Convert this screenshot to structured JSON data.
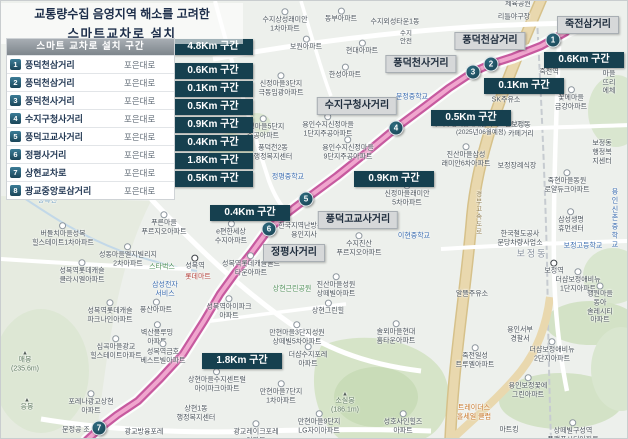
{
  "title": {
    "line1": "교통량수집 음영지역 해소를 고려한",
    "line2": "스마트교차로 설치"
  },
  "table": {
    "header": "스마트 교차로 설치 구간",
    "rows": [
      {
        "no": "1",
        "name": "풍덕천삼거리",
        "road": "포은대로"
      },
      {
        "no": "2",
        "name": "풍덕천삼거리",
        "road": "포은대로"
      },
      {
        "no": "3",
        "name": "풍덕천사거리",
        "road": "포은대로"
      },
      {
        "no": "4",
        "name": "수지구청사거리",
        "road": "포은대로"
      },
      {
        "no": "5",
        "name": "풍덕고교사거리",
        "road": "포은대로"
      },
      {
        "no": "6",
        "name": "정평사거리",
        "road": "포은대로"
      },
      {
        "no": "7",
        "name": "상현교차로",
        "road": "포은대로"
      },
      {
        "no": "8",
        "name": "광교중앙로삼거리",
        "road": "포은대로"
      }
    ]
  },
  "segments": [
    {
      "label": "4.8Km 구간",
      "x": 212,
      "y": 46
    },
    {
      "label": "0.6Km 구간",
      "x": 212,
      "y": 70
    },
    {
      "label": "0.1Km 구간",
      "x": 212,
      "y": 88
    },
    {
      "label": "0.5Km 구간",
      "x": 212,
      "y": 106
    },
    {
      "label": "0.9Km 구간",
      "x": 212,
      "y": 124
    },
    {
      "label": "0.4Km 구간",
      "x": 212,
      "y": 142
    },
    {
      "label": "1.8Km 구간",
      "x": 212,
      "y": 160
    },
    {
      "label": "0.5Km 구간",
      "x": 212,
      "y": 178
    }
  ],
  "map": {
    "colors": {
      "badge": "#16404f",
      "route_outer": "#c75a9f",
      "route_inner": "#f0a6ce",
      "plate": "#d6d8d9"
    },
    "badges": [
      {
        "label": "0.6Km 구간",
        "x": 583,
        "y": 59
      },
      {
        "label": "0.1Km 구간",
        "x": 523,
        "y": 85
      },
      {
        "label": "0.5Km 구간",
        "x": 470,
        "y": 117
      },
      {
        "label": "0.9Km 구간",
        "x": 393,
        "y": 178
      },
      {
        "label": "0.4Km 구간",
        "x": 249,
        "y": 212
      },
      {
        "label": "1.8Km 구간",
        "x": 241,
        "y": 360
      }
    ],
    "intersections": [
      {
        "label": "죽전삼거리",
        "x": 587,
        "y": 24
      },
      {
        "label": "풍덕천삼거리",
        "x": 489,
        "y": 40
      },
      {
        "label": "풍덕천사거리",
        "x": 420,
        "y": 63
      },
      {
        "label": "수지구청사거리",
        "x": 356,
        "y": 105
      },
      {
        "label": "풍덕고교사거리",
        "x": 357,
        "y": 219
      },
      {
        "label": "정평사거리",
        "x": 293,
        "y": 252
      }
    ],
    "markers": [
      {
        "n": "1",
        "x": 552,
        "y": 39
      },
      {
        "n": "2",
        "x": 490,
        "y": 63
      },
      {
        "n": "3",
        "x": 472,
        "y": 71
      },
      {
        "n": "4",
        "x": 395,
        "y": 127
      },
      {
        "n": "5",
        "x": 305,
        "y": 198
      },
      {
        "n": "6",
        "x": 268,
        "y": 228
      },
      {
        "n": "7",
        "x": 98,
        "y": 427
      }
    ],
    "labels": [
      {
        "t": "체육공원",
        "x": 517,
        "y": 4
      },
      {
        "t": "리틀야구장",
        "x": 513,
        "y": 17
      },
      {
        "t": "수지상성래미안\n1차아파트",
        "x": 284,
        "y": 20,
        "cls": "apt"
      },
      {
        "t": "동부아파트",
        "x": 340,
        "y": 15,
        "cls": "apt"
      },
      {
        "t": "수지외성타운1동",
        "x": 394,
        "y": 22
      },
      {
        "t": "보원아파트",
        "x": 305,
        "y": 43,
        "cls": "apt"
      },
      {
        "t": "현대아파트",
        "x": 361,
        "y": 47,
        "cls": "apt"
      },
      {
        "t": "한성아파트",
        "x": 344,
        "y": 71,
        "cls": "apt"
      },
      {
        "t": "수지\n안전",
        "x": 405,
        "y": 37,
        "cls": "tiny"
      },
      {
        "t": "도담마을\n뜨리에체",
        "x": 608,
        "y": 74,
        "cls": "apt"
      },
      {
        "t": "죽전역",
        "x": 548,
        "y": 68,
        "cls": "station"
      },
      {
        "t": "꽃메마을\n금강아파트",
        "x": 570,
        "y": 98,
        "cls": "apt"
      },
      {
        "t": "SK주유소",
        "x": 505,
        "y": 100
      },
      {
        "t": "신정마을3단지\n극동임광아파트",
        "x": 280,
        "y": 84,
        "cls": "apt"
      },
      {
        "t": "문정중학교",
        "x": 411,
        "y": 97,
        "cls": "blue"
      },
      {
        "t": "용인수지신정마을\n1단지주공아파트",
        "x": 327,
        "y": 125,
        "cls": "apt"
      },
      {
        "t": "신정마을5단지\n주공아파트",
        "x": 262,
        "y": 127,
        "cls": "apt"
      },
      {
        "t": "수지구청역롯데캐슬하이브엘아파트\n(2025년06월예정)",
        "x": 480,
        "y": 128,
        "cls": "tiny"
      },
      {
        "t": "풍덕천2동\n행정복지센터",
        "x": 272,
        "y": 152
      },
      {
        "t": "용인수지신정마을\n9단지주공아파트",
        "x": 347,
        "y": 148,
        "cls": "apt"
      },
      {
        "t": "정평중학교",
        "x": 287,
        "y": 177,
        "cls": "blue"
      },
      {
        "t": "신정마을래미안\n5차아파트",
        "x": 406,
        "y": 194,
        "cls": "apt"
      },
      {
        "t": "진산마을삼성\n래미안6차아파트",
        "x": 465,
        "y": 155,
        "cls": "apt"
      },
      {
        "t": "보정장례식장",
        "x": 516,
        "y": 166
      },
      {
        "t": "보정동\n카페거리",
        "x": 520,
        "y": 129
      },
      {
        "t": "보정동\n행정복지센터",
        "x": 601,
        "y": 152
      },
      {
        "t": "죽현마을동원\n로얄듀크아파트",
        "x": 566,
        "y": 181,
        "cls": "apt"
      },
      {
        "t": "경부고속도로",
        "x": 476,
        "y": 212,
        "cls": "road-v"
      },
      {
        "t": "삼성생명\n휴먼센터",
        "x": 570,
        "y": 220,
        "cls": "apt"
      },
      {
        "t": "용인신촌\n중학교",
        "x": 614,
        "y": 218,
        "cls": "blue"
      },
      {
        "t": "한국철도공사\n분당차량사업소",
        "x": 519,
        "y": 238
      },
      {
        "t": "보정동",
        "x": 531,
        "y": 253,
        "cls": "district"
      },
      {
        "t": "보정고등학교",
        "x": 582,
        "y": 246,
        "cls": "blue"
      },
      {
        "t": "보정역",
        "x": 553,
        "y": 267,
        "cls": "station"
      },
      {
        "t": "더샵보정애비뉴\n1단지아파트",
        "x": 577,
        "y": 280,
        "cls": "apt"
      },
      {
        "t": "이현중학교",
        "x": 413,
        "y": 236,
        "cls": "blue"
      },
      {
        "t": "수지진산\n푸르지오아파트",
        "x": 358,
        "y": 244,
        "cls": "apt"
      },
      {
        "t": "한국지역난방공사\n용인지사",
        "x": 303,
        "y": 230
      },
      {
        "t": "e편한세상\n수지아파트",
        "x": 230,
        "y": 232,
        "cls": "apt"
      },
      {
        "t": "성복역",
        "x": 194,
        "y": 262,
        "cls": "station"
      },
      {
        "t": "성복역롯데캐슬골드\n타운아파트",
        "x": 250,
        "y": 264,
        "cls": "apt"
      },
      {
        "t": "롯데마트",
        "x": 197,
        "y": 277,
        "cls": "red"
      },
      {
        "t": "상현근린공원",
        "x": 291,
        "y": 289,
        "cls": "green"
      },
      {
        "t": "진산마을성원\n상떼빌아파트",
        "x": 335,
        "y": 285,
        "cls": "apt"
      },
      {
        "t": "상현그린힐",
        "x": 327,
        "y": 307,
        "cls": "apt"
      },
      {
        "t": "성복천",
        "x": 46,
        "y": 201,
        "cls": "stream"
      },
      {
        "t": "버들치마을성복\n힐스테이트1차아파트",
        "x": 62,
        "y": 234,
        "cls": "apt"
      },
      {
        "t": "푸른마을\n푸르지오아파트",
        "x": 163,
        "y": 223,
        "cls": "apt"
      },
      {
        "t": "성동마을엘지빌리지\n2차아파트",
        "x": 127,
        "y": 255,
        "cls": "apt"
      },
      {
        "t": "스타벅스",
        "x": 161,
        "y": 267,
        "cls": "green"
      },
      {
        "t": "삼성전자\n서비스",
        "x": 164,
        "y": 289,
        "cls": "blue"
      },
      {
        "t": "성복역롯데캐슬\n클라시엘아파트",
        "x": 81,
        "y": 271,
        "cls": "apt"
      },
      {
        "t": "성복역롯데캐슬\n파크나인아파트",
        "x": 109,
        "y": 311,
        "cls": "apt"
      },
      {
        "t": "풍산아파트",
        "x": 155,
        "y": 306,
        "cls": "apt"
      },
      {
        "t": "성복역아이파크\n아파트",
        "x": 228,
        "y": 307,
        "cls": "apt"
      },
      {
        "t": "벽산블루밍\n아파트",
        "x": 156,
        "y": 333,
        "cls": "apt"
      },
      {
        "t": "성복역금호\n베스트빌아파트",
        "x": 162,
        "y": 352,
        "cls": "apt"
      },
      {
        "t": "심곡마을광교\n힐스테이트아파트",
        "x": 115,
        "y": 347,
        "cls": "apt"
      },
      {
        "t": "매봉\n(235.6m)",
        "x": 24,
        "y": 361,
        "cls": "peak"
      },
      {
        "t": "응봉",
        "x": 26,
        "y": 404,
        "cls": "peak"
      },
      {
        "t": "포레나광교상현\n아파트",
        "x": 90,
        "y": 402,
        "cls": "apt"
      },
      {
        "t": "문정공 조",
        "x": 75,
        "y": 430
      },
      {
        "t": "상현1동\n행정복지센터",
        "x": 195,
        "y": 413
      },
      {
        "t": "광교방융포레",
        "x": 143,
        "y": 432
      },
      {
        "t": "광교레이크포레\n아파트",
        "x": 255,
        "y": 432,
        "cls": "apt"
      },
      {
        "t": "상현마을수지센트럴\n아이파크아파트",
        "x": 216,
        "y": 380,
        "cls": "apt"
      },
      {
        "t": "만현마을3단지성원\n상떼빌5차아파트",
        "x": 296,
        "y": 333,
        "cls": "apt"
      },
      {
        "t": "솔뫼마을현대\n홈타운아파트",
        "x": 395,
        "y": 332,
        "cls": "apt"
      },
      {
        "t": "더샵수지포레\n아파트",
        "x": 307,
        "y": 355,
        "cls": "apt"
      },
      {
        "t": "만현마을7단지\n1차아파트",
        "x": 280,
        "y": 392,
        "cls": "apt"
      },
      {
        "t": "소실봉\n(186.1m)",
        "x": 344,
        "y": 402,
        "cls": "peak"
      },
      {
        "t": "만현마을9단지\nLG자이아파트",
        "x": 318,
        "y": 422,
        "cls": "apt"
      },
      {
        "t": "성호사인힐즈\n아파트",
        "x": 402,
        "y": 422,
        "cls": "apt"
      },
      {
        "t": "알뜰주유소",
        "x": 471,
        "y": 294
      },
      {
        "t": "행원마을동아\n솔레시티아파트",
        "x": 599,
        "y": 303,
        "cls": "apt"
      },
      {
        "t": "용인서부\n경찰서",
        "x": 519,
        "y": 334
      },
      {
        "t": "더샵보정애비뉴\n2단지아파트",
        "x": 551,
        "y": 350,
        "cls": "apt"
      },
      {
        "t": "죽전일성\n트루엘아파트",
        "x": 474,
        "y": 356,
        "cls": "apt"
      },
      {
        "t": "용인보정꽃에\n그린아파트",
        "x": 527,
        "y": 386,
        "cls": "apt"
      },
      {
        "t": "트레이더스\n홀세일 클럽",
        "x": 473,
        "y": 412,
        "cls": "orange"
      },
      {
        "t": "마트킹",
        "x": 508,
        "y": 430
      },
      {
        "t": "상떼빌구성역\n플랫폼시티아파트",
        "x": 572,
        "y": 431,
        "cls": "apt"
      }
    ]
  }
}
